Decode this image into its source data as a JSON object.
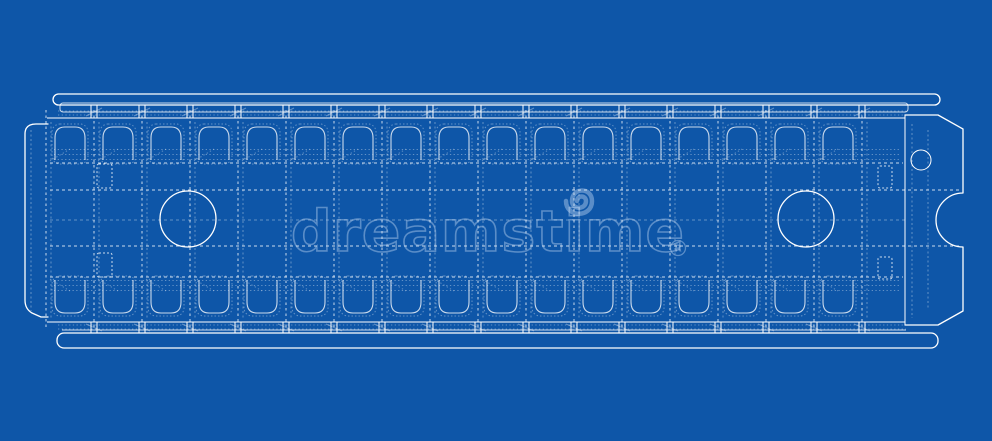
{
  "colors": {
    "background": "#0e56a8",
    "line": "#ffffff",
    "line_soft": "rgba(255,255,255,0.78)",
    "line_faint": "rgba(255,255,255,0.35)",
    "watermark": "rgba(205,226,248,0.40)"
  },
  "watermark": {
    "text": "dreamstime",
    "registered_symbol": "R",
    "logo": "spiral-logo"
  },
  "structure": {
    "grid_count": 18,
    "cell_count": 17,
    "grid_start_x": 46,
    "cell_width": 48
  }
}
